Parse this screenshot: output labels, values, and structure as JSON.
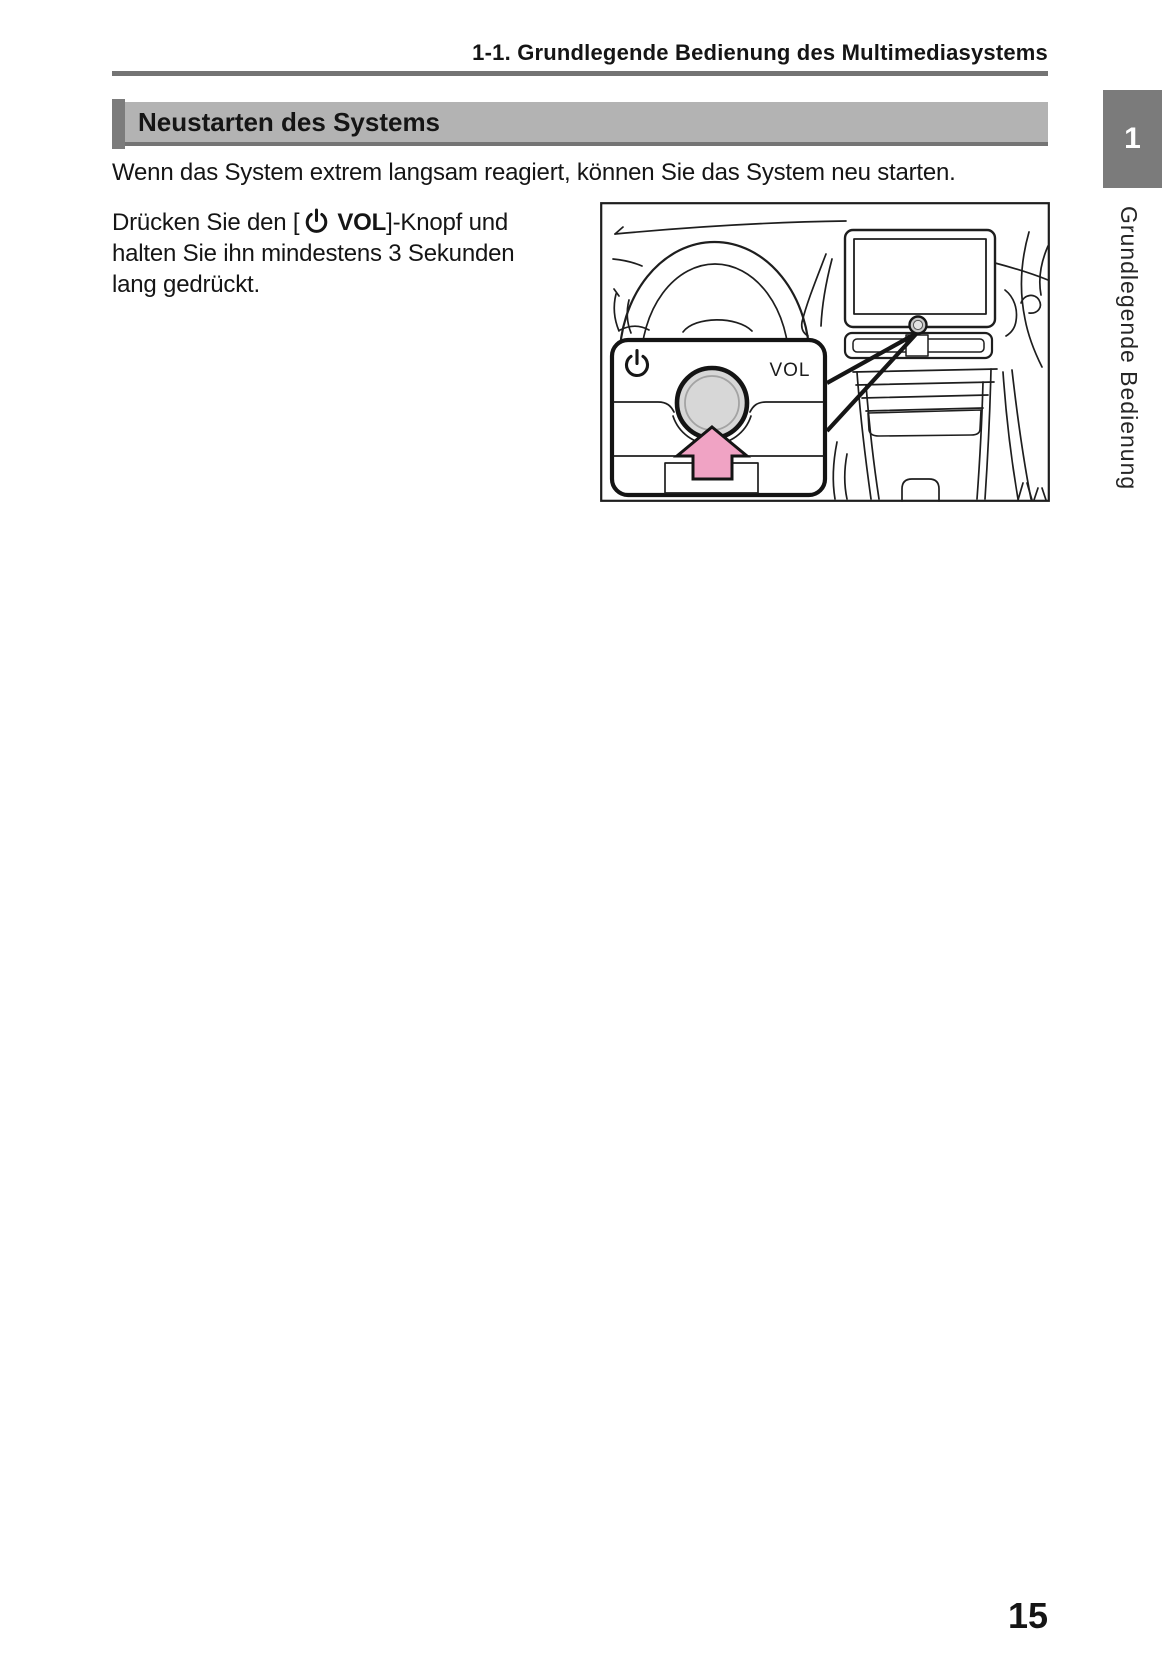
{
  "running_header": "1-1. Grundlegende Bedienung des Multimediasystems",
  "section": {
    "title": "Neustarten des Systems"
  },
  "intro": "Wenn das System extrem langsam reagiert, können Sie das System neu starten.",
  "instruction": {
    "line1_prefix": "Drücken Sie den [",
    "line1_bold": "VOL",
    "line1_suffix": "]-Knopf und",
    "line2": "halten Sie ihn mindestens 3 Sekunden",
    "line3": "lang gedrückt."
  },
  "figure": {
    "vol_label": "VOL",
    "power_icon_name": "power-symbol",
    "press_arrow_icon_name": "up-arrow",
    "arrow_color": "#F0A3C4",
    "knob_color": "#D7D7D7"
  },
  "sidebar": {
    "chapter_number": "1",
    "chapter_label": "Grundlegende Bedienung"
  },
  "footer": {
    "page_number": "15"
  },
  "colors": {
    "section_bar_bg": "#B3B3B3",
    "section_bar_accent": "#7C7C7C",
    "rule_gray": "#747474",
    "tab_gray": "#7B7B7B",
    "text_black": "#151515"
  }
}
